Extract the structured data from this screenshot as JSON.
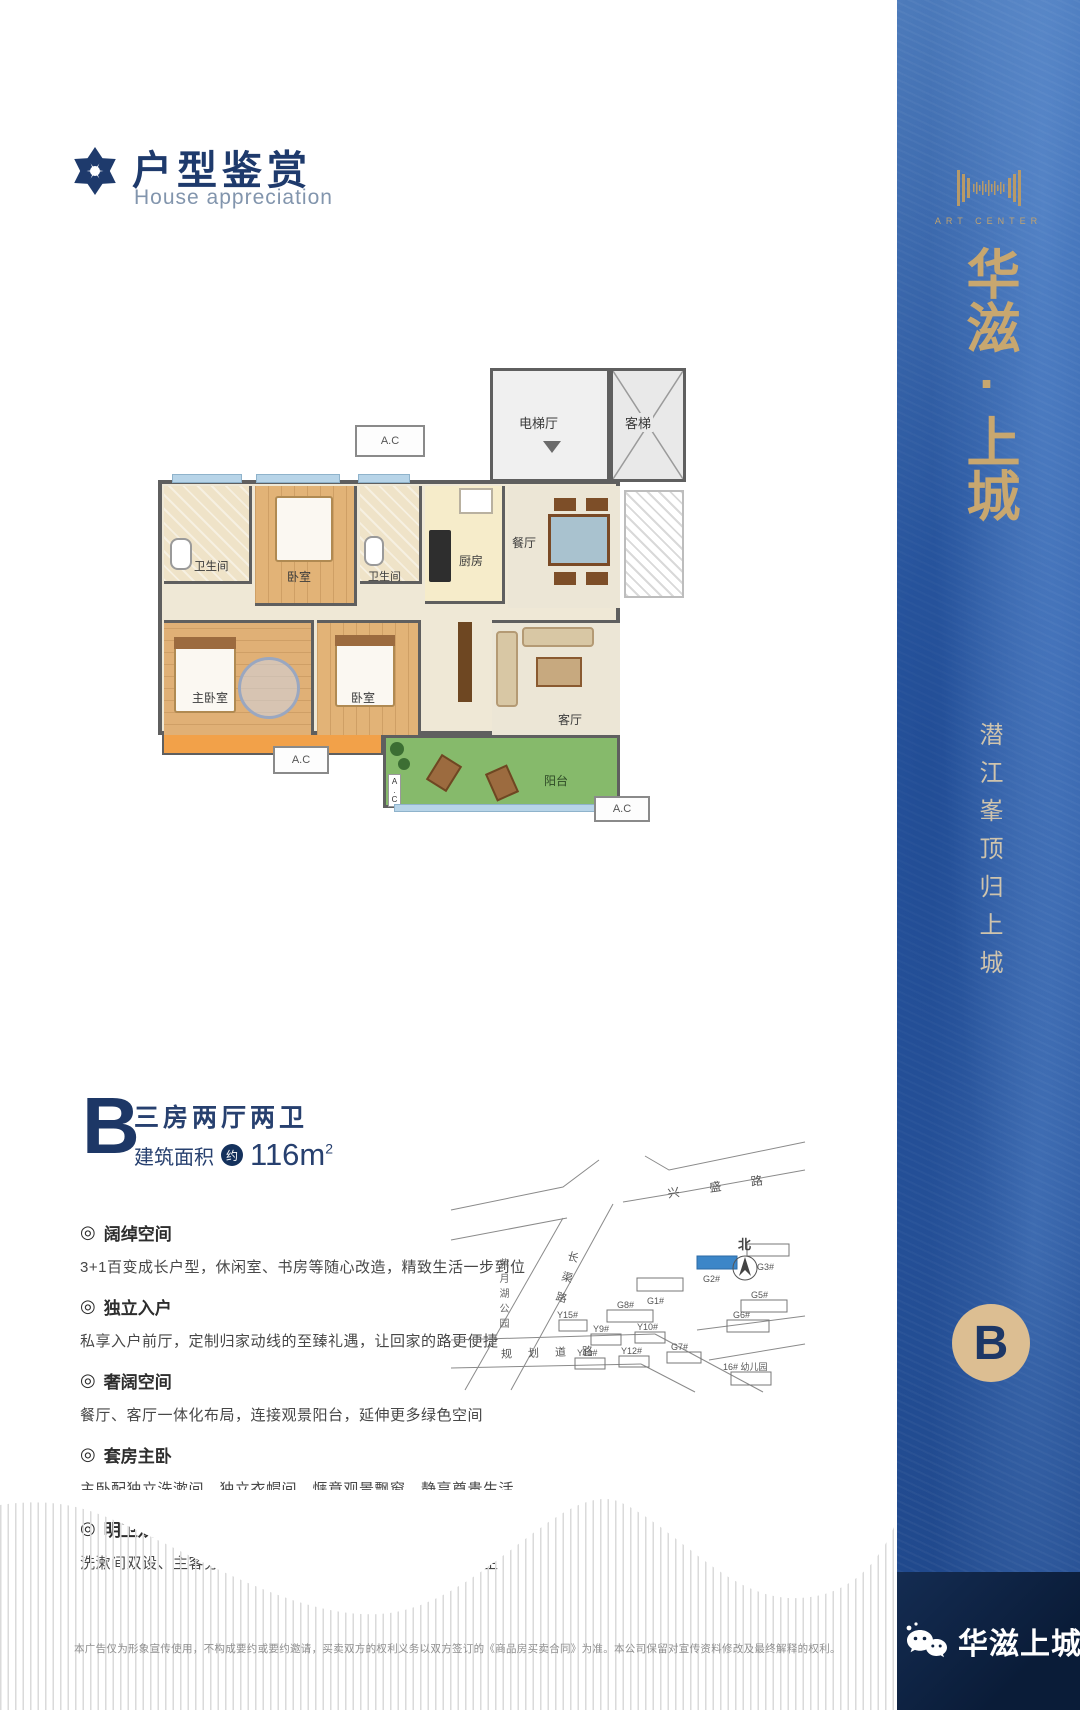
{
  "header": {
    "title": "户型鉴赏",
    "subtitle": "House appreciation"
  },
  "ui": {
    "bullet": "◎"
  },
  "floor_plan": {
    "rooms": {
      "elevator_hall": "电梯厅",
      "elevator": "客梯",
      "bathroom": "卫生间",
      "bedroom": "卧室",
      "kitchen": "厨房",
      "dining": "餐厅",
      "master_bedroom": "主卧室",
      "living_room": "客厅",
      "balcony": "阳台",
      "ac": "A.C"
    }
  },
  "unit": {
    "letter": "B",
    "layout": "三房两厅两卫",
    "area_label": "建筑面积",
    "area_approx": "约",
    "area_value": "116m",
    "area_sup": "2"
  },
  "features": [
    {
      "title": "阔绰空间",
      "desc": "3+1百变成长户型，休闲室、书房等随心改造，精致生活一步到位"
    },
    {
      "title": "独立入户",
      "desc": "私享入户前厅，定制归家动线的至臻礼遇，让回家的路更便捷"
    },
    {
      "title": "奢阔空间",
      "desc": "餐厅、客厅一体化布局，连接观景阳台，延伸更多绿色空间"
    },
    {
      "title": "套房主卧",
      "desc": "主卧配独立洗漱间、独立衣帽间、惬意观景飘窗，静享尊贵生活"
    },
    {
      "title": "明卫双设",
      "desc": "洗漱间双设、主客分离三段式布局、干湿分离、减少细菌滋生"
    }
  ],
  "site_map": {
    "road_top": "兴盛路",
    "road_bottom": "规划道路",
    "road_diagonal": "长渠路",
    "park": "紫月湖公园",
    "north": "北",
    "buildings": [
      "G1#",
      "G2#",
      "G3#",
      "G5#",
      "G6#",
      "G7#",
      "G8#",
      "Y9#",
      "Y10#",
      "Y11#",
      "Y12#",
      "Y15#",
      "16# 幼儿园"
    ]
  },
  "sidebar": {
    "logo_caption": "ART CENTER",
    "brand": "华滋·上城",
    "slogan": "潜江峯顶归上城",
    "unit_badge": "B"
  },
  "footer": {
    "disclaimer": "本广告仅为形象宣传使用，不构成要约或要约邀请，买卖双方的权利义务以双方签订的《商品房买卖合同》为准。本公司保留对宣传资料修改及最终解释的权利。",
    "brand": "华滋上城"
  }
}
